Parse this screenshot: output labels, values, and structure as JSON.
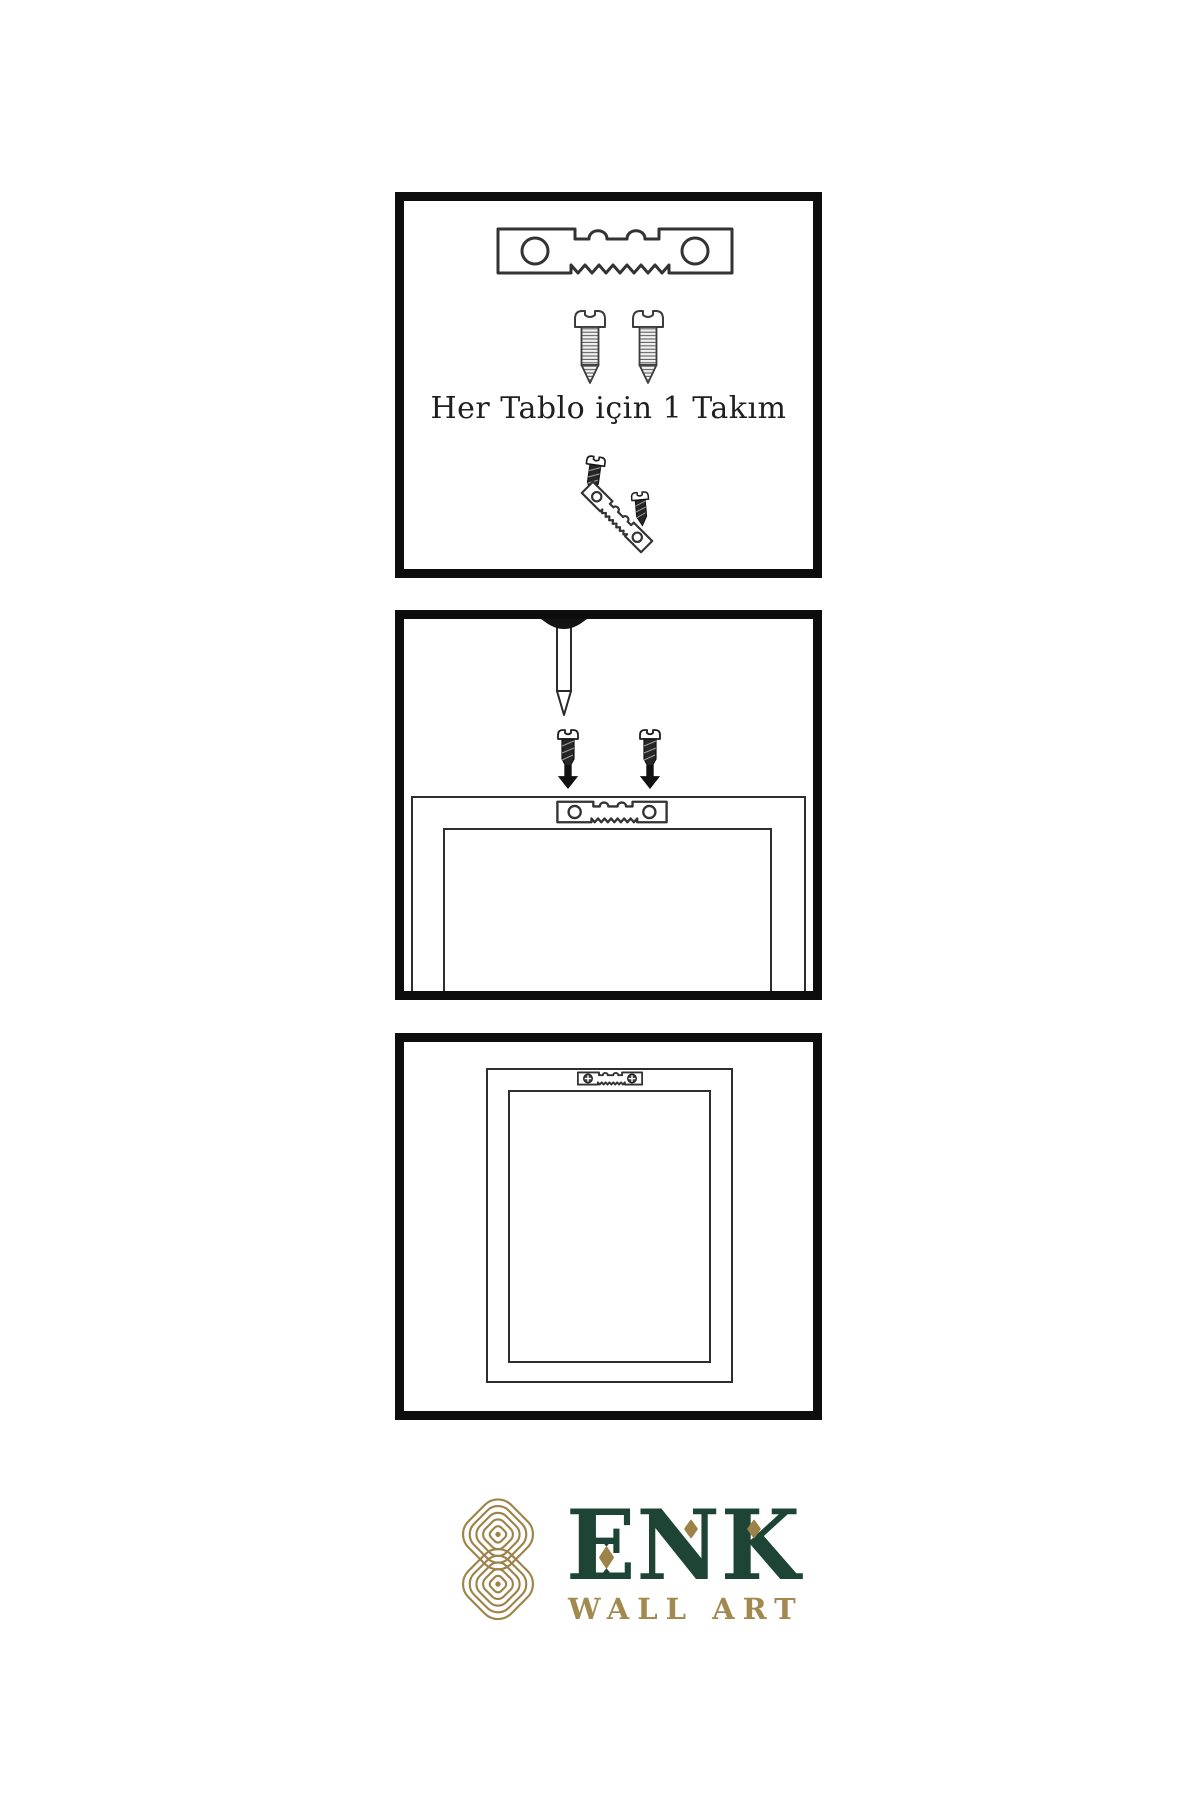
{
  "document": {
    "background": "#ffffff",
    "language": "tr"
  },
  "colors": {
    "panel_border": "#0d0d0d",
    "line_art": "#2e2e2e",
    "caption_text": "#1f1f1f",
    "brand_green": "#1d4434",
    "brand_gold": "#9d8348",
    "subtitle_gold": "#a2894f"
  },
  "panels": [
    {
      "name": "hardware-kit",
      "caption": "Her Tablo için 1 Takım",
      "icons": [
        "sawtooth-hanger-icon",
        "screw-icon",
        "screw-icon",
        "screw-into-hanger-icon"
      ]
    },
    {
      "name": "wall-mounting",
      "icons": [
        "nail-icon",
        "screw-icon",
        "screw-icon",
        "down-arrow-icon",
        "down-arrow-icon",
        "frame-back-icon",
        "sawtooth-hanger-icon"
      ]
    },
    {
      "name": "hung-frame",
      "icons": [
        "frame-back-icon",
        "mounted-sawtooth-hanger-icon"
      ]
    }
  ],
  "brand": {
    "name": "ENK",
    "subtitle": "WALL ART"
  }
}
